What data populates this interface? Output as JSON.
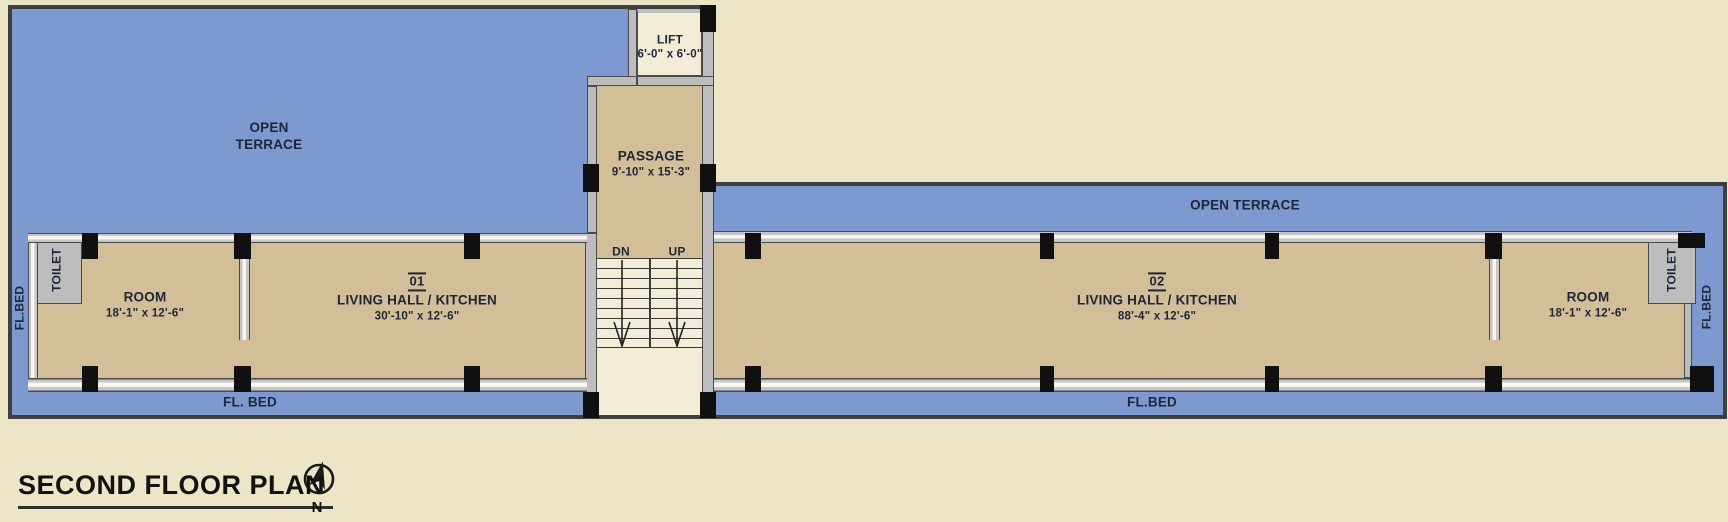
{
  "colors": {
    "background": "#ece5c6",
    "terrace_blue": "#7d9ad0",
    "room_tan": "#d3bf97",
    "light_cream": "#f3edd8",
    "toilet_teal": "#bcdcd3",
    "wall_dark": "#3f3f3f",
    "pillar_black": "#101010",
    "label_navy": "#1c2639",
    "title_black": "#121212"
  },
  "labels": {
    "terrace_left_line1": "OPEN",
    "terrace_left_line2": "TERRACE",
    "terrace_right": "OPEN TERRACE",
    "lift_name": "LIFT",
    "lift_dims": "6'-0\" x 6'-0\"",
    "passage_name": "PASSAGE",
    "passage_dims": "9'-10\" x 15'-3\"",
    "stairs_down": "DN",
    "stairs_up": "UP",
    "unit1_number": "01",
    "unit1_name": "LIVING HALL / KITCHEN",
    "unit1_dims": "30'-10\" x 12'-6\"",
    "unit2_number": "02",
    "unit2_name": "LIVING HALL / KITCHEN",
    "unit2_dims": "88'-4\" x 12'-6\"",
    "room_left_name": "ROOM",
    "room_left_dims": "18'-1\" x 12'-6\"",
    "room_right_name": "ROOM",
    "room_right_dims": "18'-1\" x 12'-6\"",
    "toilet_left": "TOILET",
    "toilet_right": "TOILET",
    "flbed_left_vertical": "FL.BED",
    "flbed_right_vertical": "FL.BED",
    "flbed_bottom_left": "FL. BED",
    "flbed_bottom_right": "FL.BED",
    "plan_title": "SECOND FLOOR PLAN",
    "compass_north": "N"
  }
}
